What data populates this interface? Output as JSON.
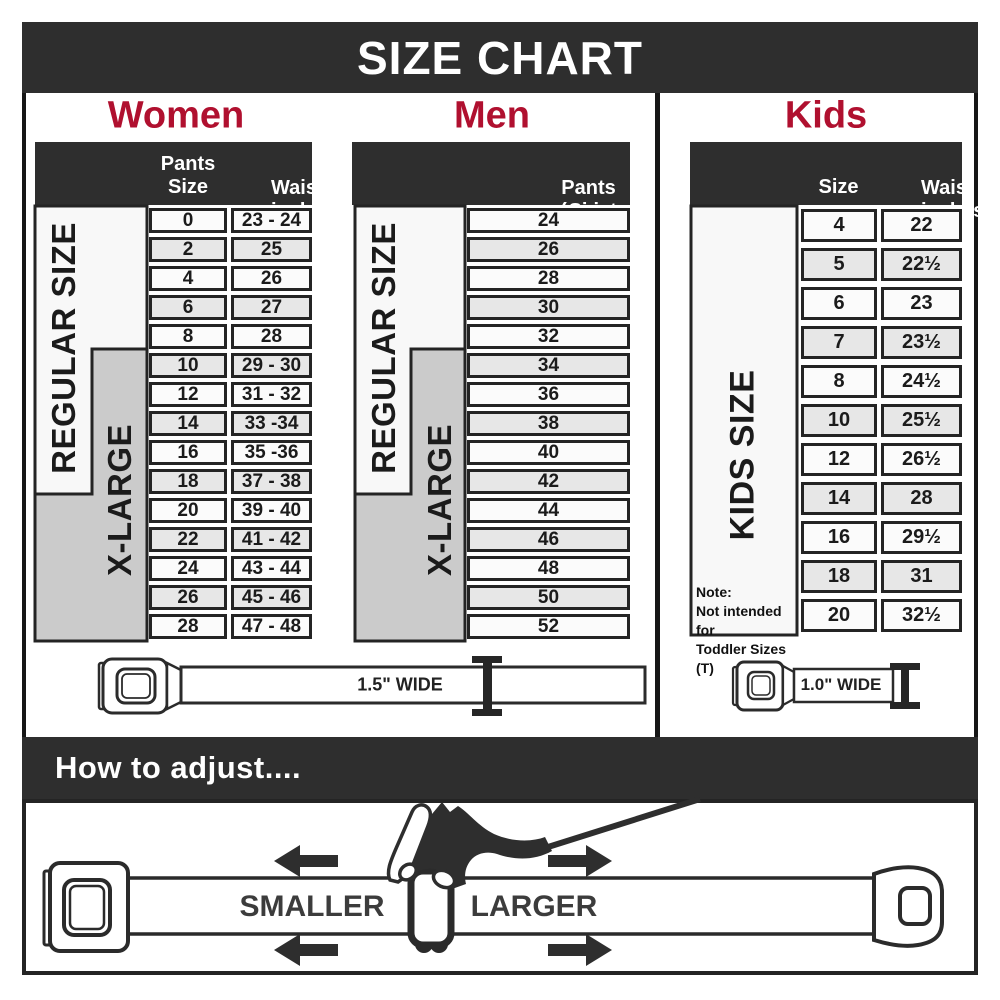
{
  "title": "SIZE CHART",
  "colors": {
    "accent": "#b0102f",
    "bar_dark": "#2e2e2e",
    "bracket_gray": "#cbcbcb",
    "row_alt": "#e7e7e7"
  },
  "women": {
    "heading": "Women",
    "col1": "Pants Size",
    "col2_line1": "Waist",
    "col2_line2": "inches",
    "regular_label": "REGULAR SIZE",
    "xlarge_label": "X-LARGE",
    "rows": [
      {
        "size": "0",
        "waist": "23 - 24"
      },
      {
        "size": "2",
        "waist": "25"
      },
      {
        "size": "4",
        "waist": "26"
      },
      {
        "size": "6",
        "waist": "27"
      },
      {
        "size": "8",
        "waist": "28"
      },
      {
        "size": "10",
        "waist": "29 - 30"
      },
      {
        "size": "12",
        "waist": "31 - 32"
      },
      {
        "size": "14",
        "waist": "33 -34"
      },
      {
        "size": "16",
        "waist": "35 -36"
      },
      {
        "size": "18",
        "waist": "37 - 38"
      },
      {
        "size": "20",
        "waist": "39 - 40"
      },
      {
        "size": "22",
        "waist": "41 - 42"
      },
      {
        "size": "24",
        "waist": "43 - 44"
      },
      {
        "size": "26",
        "waist": "45 - 46"
      },
      {
        "size": "28",
        "waist": "47 - 48"
      }
    ]
  },
  "men": {
    "heading": "Men",
    "col_line1": "Pants Size",
    "col_line2": "(waist inches)",
    "regular_label": "REGULAR SIZE",
    "xlarge_label": "X-LARGE",
    "rows": [
      "24",
      "26",
      "28",
      "30",
      "32",
      "34",
      "36",
      "38",
      "40",
      "42",
      "44",
      "46",
      "48",
      "50",
      "52"
    ]
  },
  "kids": {
    "heading": "Kids",
    "col1": "Size",
    "col2_line1": "Waist",
    "col2_line2": "inches",
    "side_label": "KIDS SIZE",
    "note_line1": "Note:",
    "note_line2": "Not intended for",
    "note_line3": "Toddler Sizes (T)",
    "rows": [
      {
        "size": "4",
        "waist": "22"
      },
      {
        "size": "5",
        "waist": "22½"
      },
      {
        "size": "6",
        "waist": "23"
      },
      {
        "size": "7",
        "waist": "23½"
      },
      {
        "size": "8",
        "waist": "24½"
      },
      {
        "size": "10",
        "waist": "25½"
      },
      {
        "size": "12",
        "waist": "26½"
      },
      {
        "size": "14",
        "waist": "28"
      },
      {
        "size": "16",
        "waist": "29½"
      },
      {
        "size": "18",
        "waist": "31"
      },
      {
        "size": "20",
        "waist": "32½"
      }
    ]
  },
  "belts": {
    "adult_width_label": "1.5\" WIDE",
    "kids_width_label": "1.0\" WIDE"
  },
  "adjust": {
    "heading": "How to adjust....",
    "smaller_label": "SMALLER",
    "larger_label": "LARGER"
  }
}
